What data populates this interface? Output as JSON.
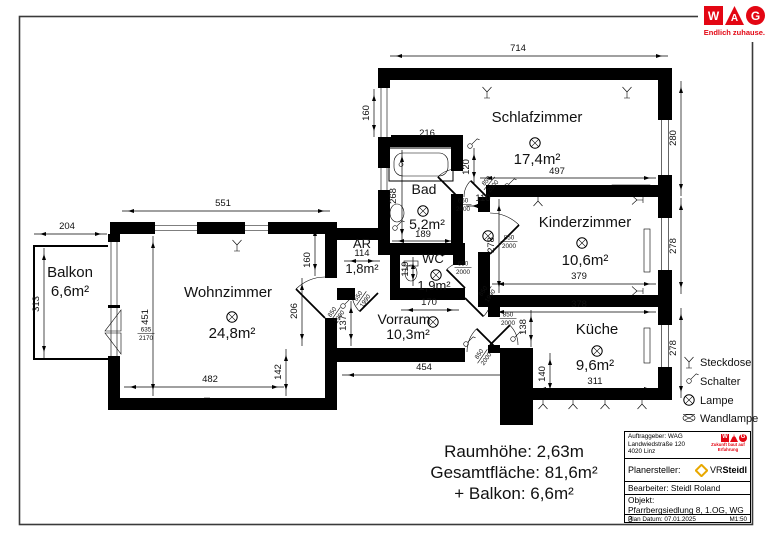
{
  "logo": {
    "w": "W",
    "a": "A",
    "g": "G",
    "tagline": "Endlich zuhause.",
    "red": "#e30613"
  },
  "rooms": [
    {
      "name": "Balkon",
      "area": "6,6m²",
      "x": 70,
      "y": 277,
      "ax": 70,
      "ay": 296,
      "fs": 15
    },
    {
      "name": "Wohnzimmer",
      "area": "24,8m²",
      "x": 228,
      "y": 297,
      "ax": 232,
      "ay": 338,
      "fs": 15
    },
    {
      "name": "AR",
      "area": "1,8m²",
      "x": 362,
      "y": 248,
      "ax": 362,
      "ay": 273,
      "fs": 13
    },
    {
      "name": "Bad",
      "area": "5,2m²",
      "x": 424,
      "y": 194,
      "ax": 427,
      "ay": 229,
      "fs": 14
    },
    {
      "name": "WC",
      "area": "1,9m²",
      "x": 433,
      "y": 263,
      "ax": 434,
      "ay": 290,
      "fs": 13
    },
    {
      "name": "Vorraum",
      "area": "10,3m²",
      "x": 404,
      "y": 324,
      "ax": 408,
      "ay": 339,
      "fs": 14
    },
    {
      "name": "Schlafzimmer",
      "area": "17,4m²",
      "x": 537,
      "y": 122,
      "ax": 537,
      "ay": 164,
      "fs": 15
    },
    {
      "name": "Kinderzimmer",
      "area": "10,6m²",
      "x": 585,
      "y": 227,
      "ax": 585,
      "ay": 265,
      "fs": 15
    },
    {
      "name": "Küche",
      "area": "9,6m²",
      "x": 597,
      "y": 334,
      "ax": 595,
      "ay": 370,
      "fs": 15
    }
  ],
  "lamps": [
    [
      232,
      317
    ],
    [
      423,
      211
    ],
    [
      436,
      275
    ],
    [
      433,
      322
    ],
    [
      535,
      143
    ],
    [
      582,
      243
    ],
    [
      597,
      351
    ],
    [
      488,
      236
    ]
  ],
  "dimensions": [
    {
      "t": "714",
      "x": 518,
      "y": 51,
      "line": [
        390,
        56,
        668,
        56
      ]
    },
    {
      "t": "160",
      "x": 369,
      "y": 113,
      "r": -90,
      "line": [
        374,
        89,
        374,
        137
      ]
    },
    {
      "t": "216",
      "x": 427,
      "y": 136,
      "line": [
        392,
        140,
        461,
        140
      ]
    },
    {
      "t": "497",
      "x": 557,
      "y": 174,
      "line": [
        480,
        178,
        656,
        178
      ]
    },
    {
      "t": "120",
      "x": 469,
      "y": 167,
      "r": -90,
      "line": [
        474,
        148,
        474,
        184
      ]
    },
    {
      "t": "110",
      "x": 483,
      "y": 201,
      "line": [
        466,
        206,
        489,
        206
      ]
    },
    {
      "t": "268",
      "x": 396,
      "y": 196,
      "r": -90,
      "line": [
        402,
        150,
        402,
        241
      ]
    },
    {
      "t": "189",
      "x": 423,
      "y": 237,
      "line": [
        392,
        241,
        457,
        241
      ]
    },
    {
      "t": "119",
      "x": 408,
      "y": 269,
      "r": -90,
      "line": [
        413,
        257,
        413,
        286
      ]
    },
    {
      "t": "170",
      "x": 429,
      "y": 305,
      "line": [
        401,
        310,
        459,
        310
      ]
    },
    {
      "t": "551",
      "x": 223,
      "y": 206,
      "line": [
        122,
        211,
        330,
        211
      ]
    },
    {
      "t": "204",
      "x": 67,
      "y": 229,
      "line": [
        34,
        234,
        107,
        234
      ]
    },
    {
      "t": "313",
      "x": 39,
      "y": 304,
      "r": -90,
      "line": [
        44,
        248,
        44,
        358
      ]
    },
    {
      "t": "451",
      "x": 148,
      "y": 317,
      "r": -90,
      "line": [
        153,
        236,
        153,
        396
      ]
    },
    {
      "t": "482",
      "x": 210,
      "y": 382,
      "line": [
        124,
        387,
        284,
        387
      ]
    },
    {
      "t": "142",
      "x": 281,
      "y": 372,
      "r": -90,
      "line": [
        286,
        349,
        286,
        396
      ]
    },
    {
      "t": "206",
      "x": 297,
      "y": 311,
      "r": -90,
      "line": [
        302,
        278,
        302,
        346
      ]
    },
    {
      "t": "160",
      "x": 310,
      "y": 260,
      "r": -90,
      "line": [
        315,
        224,
        315,
        276
      ]
    },
    {
      "t": "137",
      "x": 346,
      "y": 323,
      "r": -90,
      "line": [
        351,
        301,
        351,
        346
      ]
    },
    {
      "t": "114",
      "x": 362,
      "y": 256,
      "line": [
        344,
        261,
        380,
        261
      ]
    },
    {
      "t": "454",
      "x": 424,
      "y": 370,
      "line": [
        342,
        375,
        518,
        375
      ]
    },
    {
      "t": "278",
      "x": 494,
      "y": 245,
      "r": -90,
      "line": [
        499,
        199,
        499,
        293
      ]
    },
    {
      "t": "379",
      "x": 579,
      "y": 279,
      "line": [
        492,
        284,
        656,
        284
      ]
    },
    {
      "t": "378",
      "x": 579,
      "y": 307,
      "line": [
        492,
        312,
        656,
        312
      ]
    },
    {
      "t": "311",
      "x": 595,
      "y": 384,
      "line": [
        534,
        389,
        656,
        389
      ]
    },
    {
      "t": "140",
      "x": 545,
      "y": 374,
      "r": -90,
      "line": [
        550,
        353,
        550,
        395
      ]
    },
    {
      "t": "138",
      "x": 526,
      "y": 327,
      "r": -90,
      "line": [
        531,
        310,
        531,
        347
      ]
    },
    {
      "t": "280",
      "x": 676,
      "y": 138,
      "r": -90,
      "line": [
        681,
        81,
        681,
        196
      ]
    },
    {
      "t": "278",
      "x": 676,
      "y": 246,
      "r": -90,
      "line": [
        681,
        198,
        681,
        294
      ]
    },
    {
      "t": "278",
      "x": 676,
      "y": 348,
      "r": -90,
      "line": [
        681,
        308,
        681,
        398
      ]
    }
  ],
  "door_labels": [
    {
      "top": "850",
      "bot": "2000",
      "x": 489,
      "y": 183,
      "r": -50
    },
    {
      "top": "650",
      "bot": "2000",
      "x": 463,
      "y": 204,
      "r": 0
    },
    {
      "top": "850",
      "bot": "2000",
      "x": 509,
      "y": 241,
      "r": 0
    },
    {
      "top": "650",
      "bot": "2000",
      "x": 463,
      "y": 267,
      "r": 0
    },
    {
      "top": "850",
      "bot": "1990",
      "x": 335,
      "y": 314,
      "r": -55
    },
    {
      "top": "650",
      "bot": "1990",
      "x": 361,
      "y": 298,
      "r": -55
    },
    {
      "top": "850",
      "bot": "2000",
      "x": 482,
      "y": 356,
      "r": -55
    },
    {
      "top": "850",
      "bot": "1990",
      "x": 486,
      "y": 293,
      "r": -55
    },
    {
      "top": "850",
      "bot": "2000",
      "x": 508,
      "y": 318,
      "r": 0
    },
    {
      "top": "635",
      "bot": "2170",
      "x": 146,
      "y": 333,
      "r": 0
    }
  ],
  "symbols": [
    {
      "k": "steckdose",
      "x": 487,
      "y": 92
    },
    {
      "k": "steckdose",
      "x": 627,
      "y": 92
    },
    {
      "k": "steckdose",
      "x": 237,
      "y": 245
    },
    {
      "k": "steckdose",
      "x": 207,
      "y": 404,
      "r": 180
    },
    {
      "k": "steckdose",
      "x": 543,
      "y": 404,
      "r": 180
    },
    {
      "k": "steckdose",
      "x": 573,
      "y": 404,
      "r": 180
    },
    {
      "k": "steckdose",
      "x": 605,
      "y": 404,
      "r": 180
    },
    {
      "k": "steckdose",
      "x": 642,
      "y": 404,
      "r": 180
    },
    {
      "k": "steckdose",
      "x": 538,
      "y": 201,
      "r": 180
    },
    {
      "k": "steckdose",
      "x": 637,
      "y": 200,
      "r": -90
    },
    {
      "k": "steckdose",
      "x": 637,
      "y": 291,
      "r": -90
    },
    {
      "k": "schalter",
      "x": 470,
      "y": 146
    },
    {
      "k": "schalter",
      "x": 507,
      "y": 186
    },
    {
      "k": "schalter",
      "x": 395,
      "y": 228
    },
    {
      "k": "schalter",
      "x": 343,
      "y": 306
    },
    {
      "k": "schalter",
      "x": 466,
      "y": 344
    },
    {
      "k": "schalter",
      "x": 513,
      "y": 339
    },
    {
      "k": "schalter",
      "x": 443,
      "y": 253
    }
  ],
  "legend": {
    "items": [
      {
        "label": "Steckdose",
        "k": "steckdose"
      },
      {
        "label": "Schalter",
        "k": "schalter"
      },
      {
        "label": "Lampe",
        "k": "lampe"
      },
      {
        "label": "Wandlampe",
        "k": "wandlampe"
      }
    ]
  },
  "summary": {
    "line1": "Raumhöhe: 2,63m",
    "line2": "Gesamtfläche: 81,6m²",
    "line3": "+ Balkon: 6,6m²"
  },
  "titleblock": {
    "client_line1": "Auftraggeber: WAG",
    "client_line2": "Landwiedstraße 120",
    "client_line3": "4020 Linz",
    "mini_tagline": "Zukunft baut auf Erfahrung",
    "planner_label": "Planersteller:",
    "planner_vr": "VR",
    "planner_steidl": "Steidl",
    "editor": "Bearbeiter: Steidl Roland",
    "object_label": "Objekt:",
    "object_value": "Pfarrbergsiedlung 8, 1.OG, WG 3",
    "date": "Plan Datum: 07.01.2025",
    "scale": "M1:50"
  }
}
